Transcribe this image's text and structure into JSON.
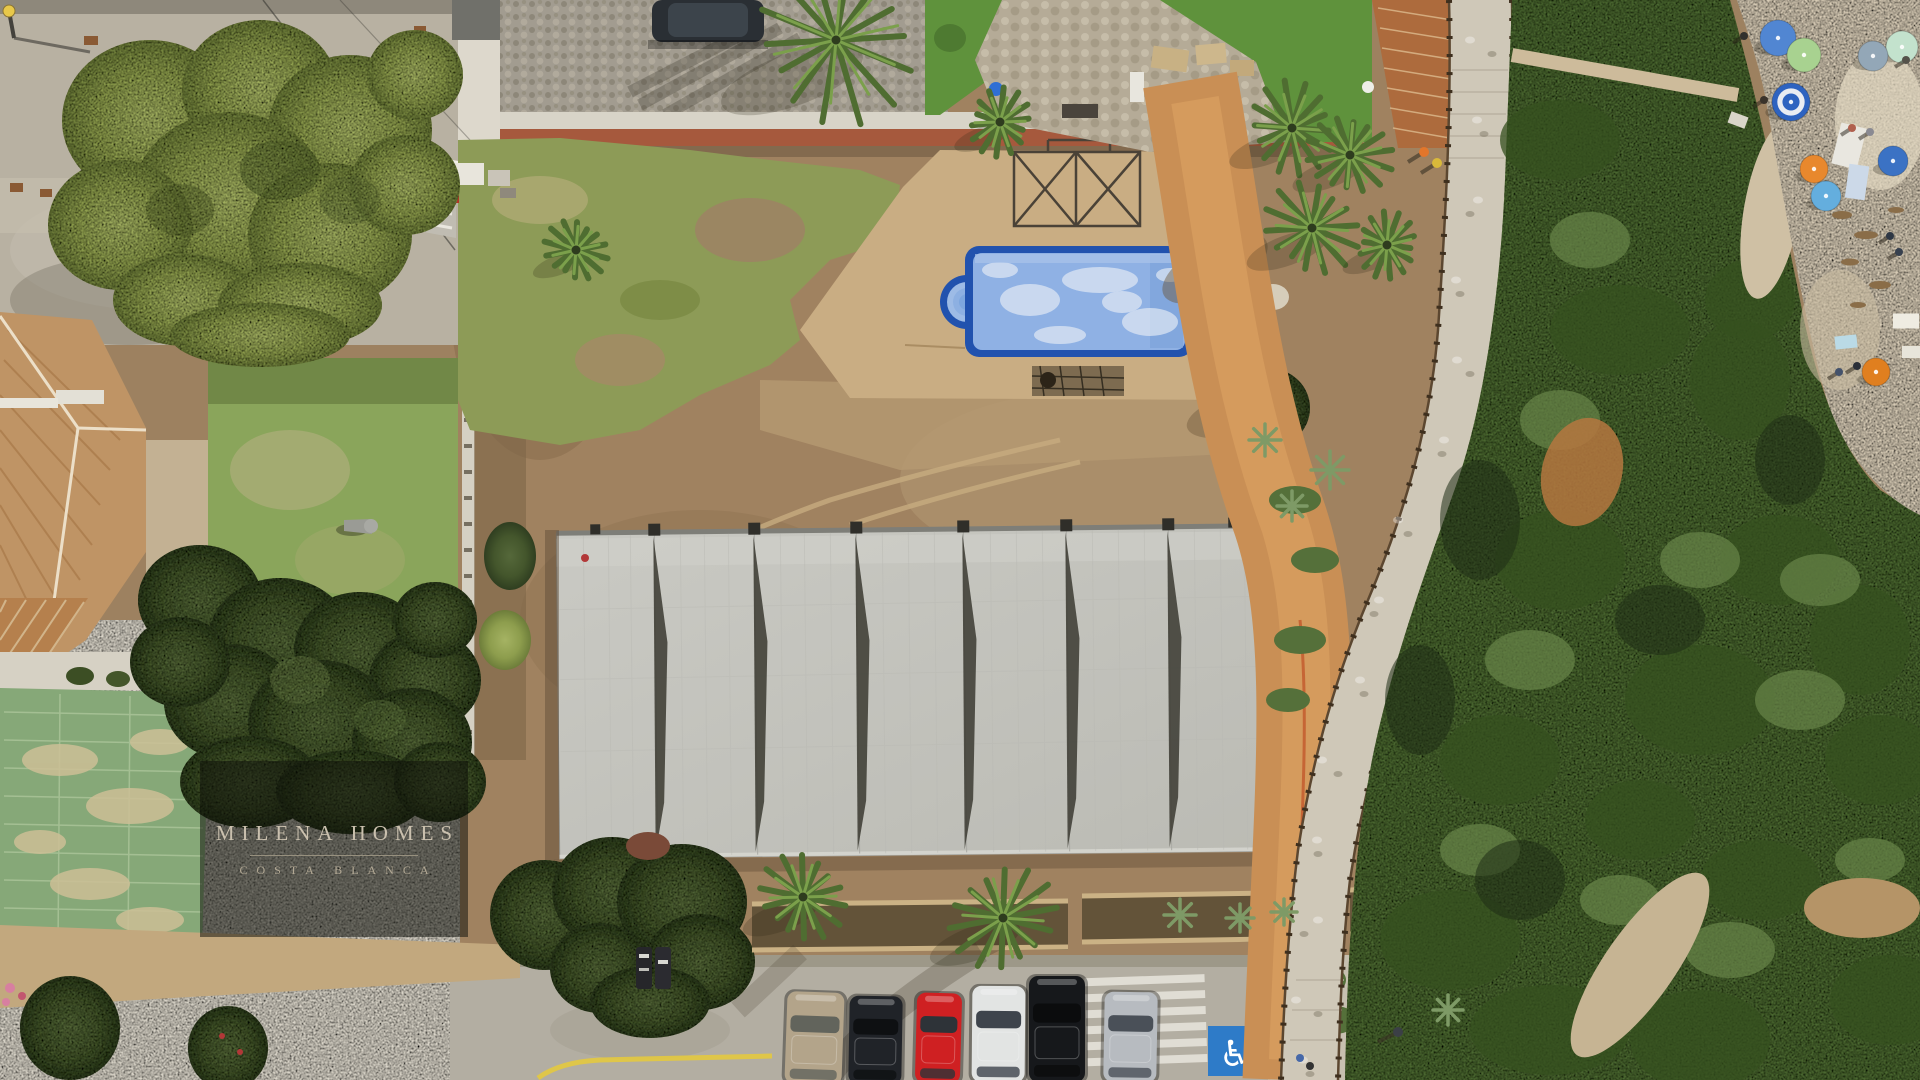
{
  "image": {
    "kind": "aerial drone photograph",
    "subject": "seafront plot with building under construction, empty pool, parking row, coastal boardwalk and beach"
  },
  "watermark": {
    "brand": "MILENA HOMES",
    "region": "COSTA BLANCA"
  },
  "palette": {
    "pool_rim": "#2152ae",
    "pool_water": "#8fb1e4",
    "deck": "#c9ad83",
    "plot_dirt": "#a08260",
    "grass": "#8d9b57",
    "lawn": "#8aa55b",
    "court_green": "#86a878",
    "roof_concrete": "#c6c6c0",
    "terracotta": "#b5804d",
    "turf": "#5f923c",
    "plaza": "#b8b1a2",
    "parking": "#b3aea2",
    "sand": "#d7cbb5",
    "scrub": "#4c6832",
    "orange_dirt": "#c98f55",
    "path_stone": "#cfc8b8",
    "accessible_blue": "#2e7bc8",
    "yellow_line": "#e3c93f"
  },
  "parking": {
    "accessible_space": {
      "symbol": "♿"
    },
    "cars": [
      {
        "name": "beige-car",
        "x": 786,
        "y": 992,
        "w": 57,
        "h": 92,
        "rot": 2,
        "body": "#b3a48a",
        "glass": "#62645c"
      },
      {
        "name": "black-car",
        "x": 849,
        "y": 996,
        "w": 53,
        "h": 88,
        "rot": 1,
        "body": "#202328",
        "glass": "#0e1012"
      },
      {
        "name": "red-car",
        "x": 916,
        "y": 993,
        "w": 45,
        "h": 90,
        "rot": 1.5,
        "body": "#cf2022",
        "glass": "#2e3338"
      },
      {
        "name": "white-car",
        "x": 972,
        "y": 986,
        "w": 53,
        "h": 96,
        "rot": 0.5,
        "body": "#e2e4e3",
        "glass": "#3e444c"
      },
      {
        "name": "black-suv",
        "x": 1029,
        "y": 976,
        "w": 56,
        "h": 106,
        "rot": 0,
        "body": "#16181b",
        "glass": "#0b0c0d"
      },
      {
        "name": "silver-suv",
        "x": 1104,
        "y": 992,
        "w": 53,
        "h": 90,
        "rot": 1,
        "body": "#b7bbc0",
        "glass": "#4a5058"
      }
    ]
  },
  "beach": {
    "umbrellas": [
      {
        "x": 1778,
        "y": 38,
        "r": 18,
        "c": "#5186d2",
        "rings": false
      },
      {
        "x": 1804,
        "y": 55,
        "r": 17,
        "c": "#a8d290",
        "rings": false
      },
      {
        "x": 1902,
        "y": 47,
        "r": 16,
        "c": "#c3e2cd",
        "rings": false
      },
      {
        "x": 1873,
        "y": 56,
        "r": 15,
        "c": "#93a7b7",
        "rings": false
      },
      {
        "x": 1791,
        "y": 102,
        "r": 19,
        "c": "#2e63c0",
        "rings": true
      },
      {
        "x": 1814,
        "y": 169,
        "r": 14,
        "c": "#e8882d",
        "rings": false
      },
      {
        "x": 1826,
        "y": 196,
        "r": 15,
        "c": "#64aede",
        "rings": false
      },
      {
        "x": 1893,
        "y": 161,
        "r": 15,
        "c": "#3b72c4",
        "rings": false
      },
      {
        "x": 1876,
        "y": 372,
        "r": 14,
        "c": "#e07f1f",
        "rings": false
      }
    ],
    "towels": [
      {
        "x": 1849,
        "y": 146,
        "w": 26,
        "h": 42,
        "rot": 14,
        "c": "#e9e7e0"
      },
      {
        "x": 1857,
        "y": 182,
        "w": 20,
        "h": 34,
        "rot": 8,
        "c": "#ccd9e8"
      },
      {
        "x": 1906,
        "y": 321,
        "w": 26,
        "h": 15,
        "rot": 0,
        "c": "#efece2"
      },
      {
        "x": 1846,
        "y": 342,
        "w": 22,
        "h": 13,
        "rot": -6,
        "c": "#badae6"
      },
      {
        "x": 1911,
        "y": 352,
        "w": 18,
        "h": 12,
        "rot": 0,
        "c": "#e8e5da"
      },
      {
        "x": 1738,
        "y": 120,
        "w": 18,
        "h": 12,
        "rot": 20,
        "c": "#d9d5c9"
      }
    ],
    "people": [
      {
        "x": 1764,
        "y": 100,
        "c": "#3a332b"
      },
      {
        "x": 1744,
        "y": 36,
        "c": "#32302c"
      },
      {
        "x": 1852,
        "y": 128,
        "c": "#b0604e"
      },
      {
        "x": 1870,
        "y": 132,
        "c": "#8a8a92"
      },
      {
        "x": 1890,
        "y": 236,
        "c": "#2e3744"
      },
      {
        "x": 1899,
        "y": 252,
        "c": "#37404e"
      },
      {
        "x": 1857,
        "y": 366,
        "c": "#2b2f38"
      },
      {
        "x": 1839,
        "y": 372,
        "c": "#44526b"
      },
      {
        "x": 1906,
        "y": 60,
        "c": "#55524a"
      }
    ]
  },
  "vegetation": {
    "palms": [
      {
        "x": 836,
        "y": 40,
        "r": 88
      },
      {
        "x": 1000,
        "y": 122,
        "r": 35
      },
      {
        "x": 1292,
        "y": 128,
        "r": 48
      },
      {
        "x": 1350,
        "y": 155,
        "r": 44
      },
      {
        "x": 1312,
        "y": 228,
        "r": 50
      },
      {
        "x": 1387,
        "y": 245,
        "r": 34
      },
      {
        "x": 576,
        "y": 250,
        "r": 33
      },
      {
        "x": 803,
        "y": 897,
        "r": 46
      },
      {
        "x": 1003,
        "y": 918,
        "r": 56
      }
    ]
  }
}
